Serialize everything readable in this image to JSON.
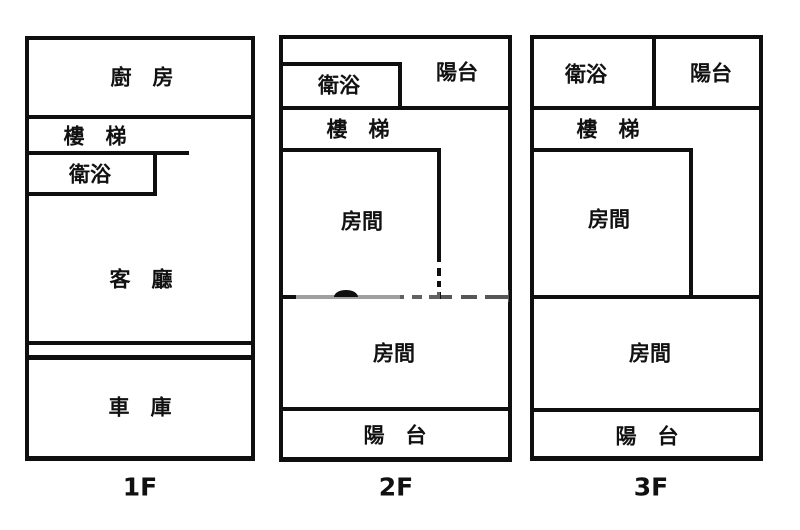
{
  "colors": {
    "background": "#ffffff",
    "wall": "#0f0f0f",
    "text": "#111111"
  },
  "floors": [
    {
      "label": "1F",
      "rooms": {
        "kitchen": "廚　房",
        "stairs": "樓　梯",
        "bath": "衛浴",
        "living": "客　廳",
        "garage": "車　庫"
      }
    },
    {
      "label": "2F",
      "rooms": {
        "bath": "衛浴",
        "balcony_top": "陽台",
        "stairs": "樓　梯",
        "room1": "房間",
        "room2": "房間",
        "balcony_bottom": "陽　台"
      }
    },
    {
      "label": "3F",
      "rooms": {
        "bath": "衛浴",
        "balcony_top": "陽台",
        "stairs": "樓　梯",
        "room1": "房間",
        "room2": "房間",
        "balcony_bottom": "陽　台"
      }
    }
  ]
}
